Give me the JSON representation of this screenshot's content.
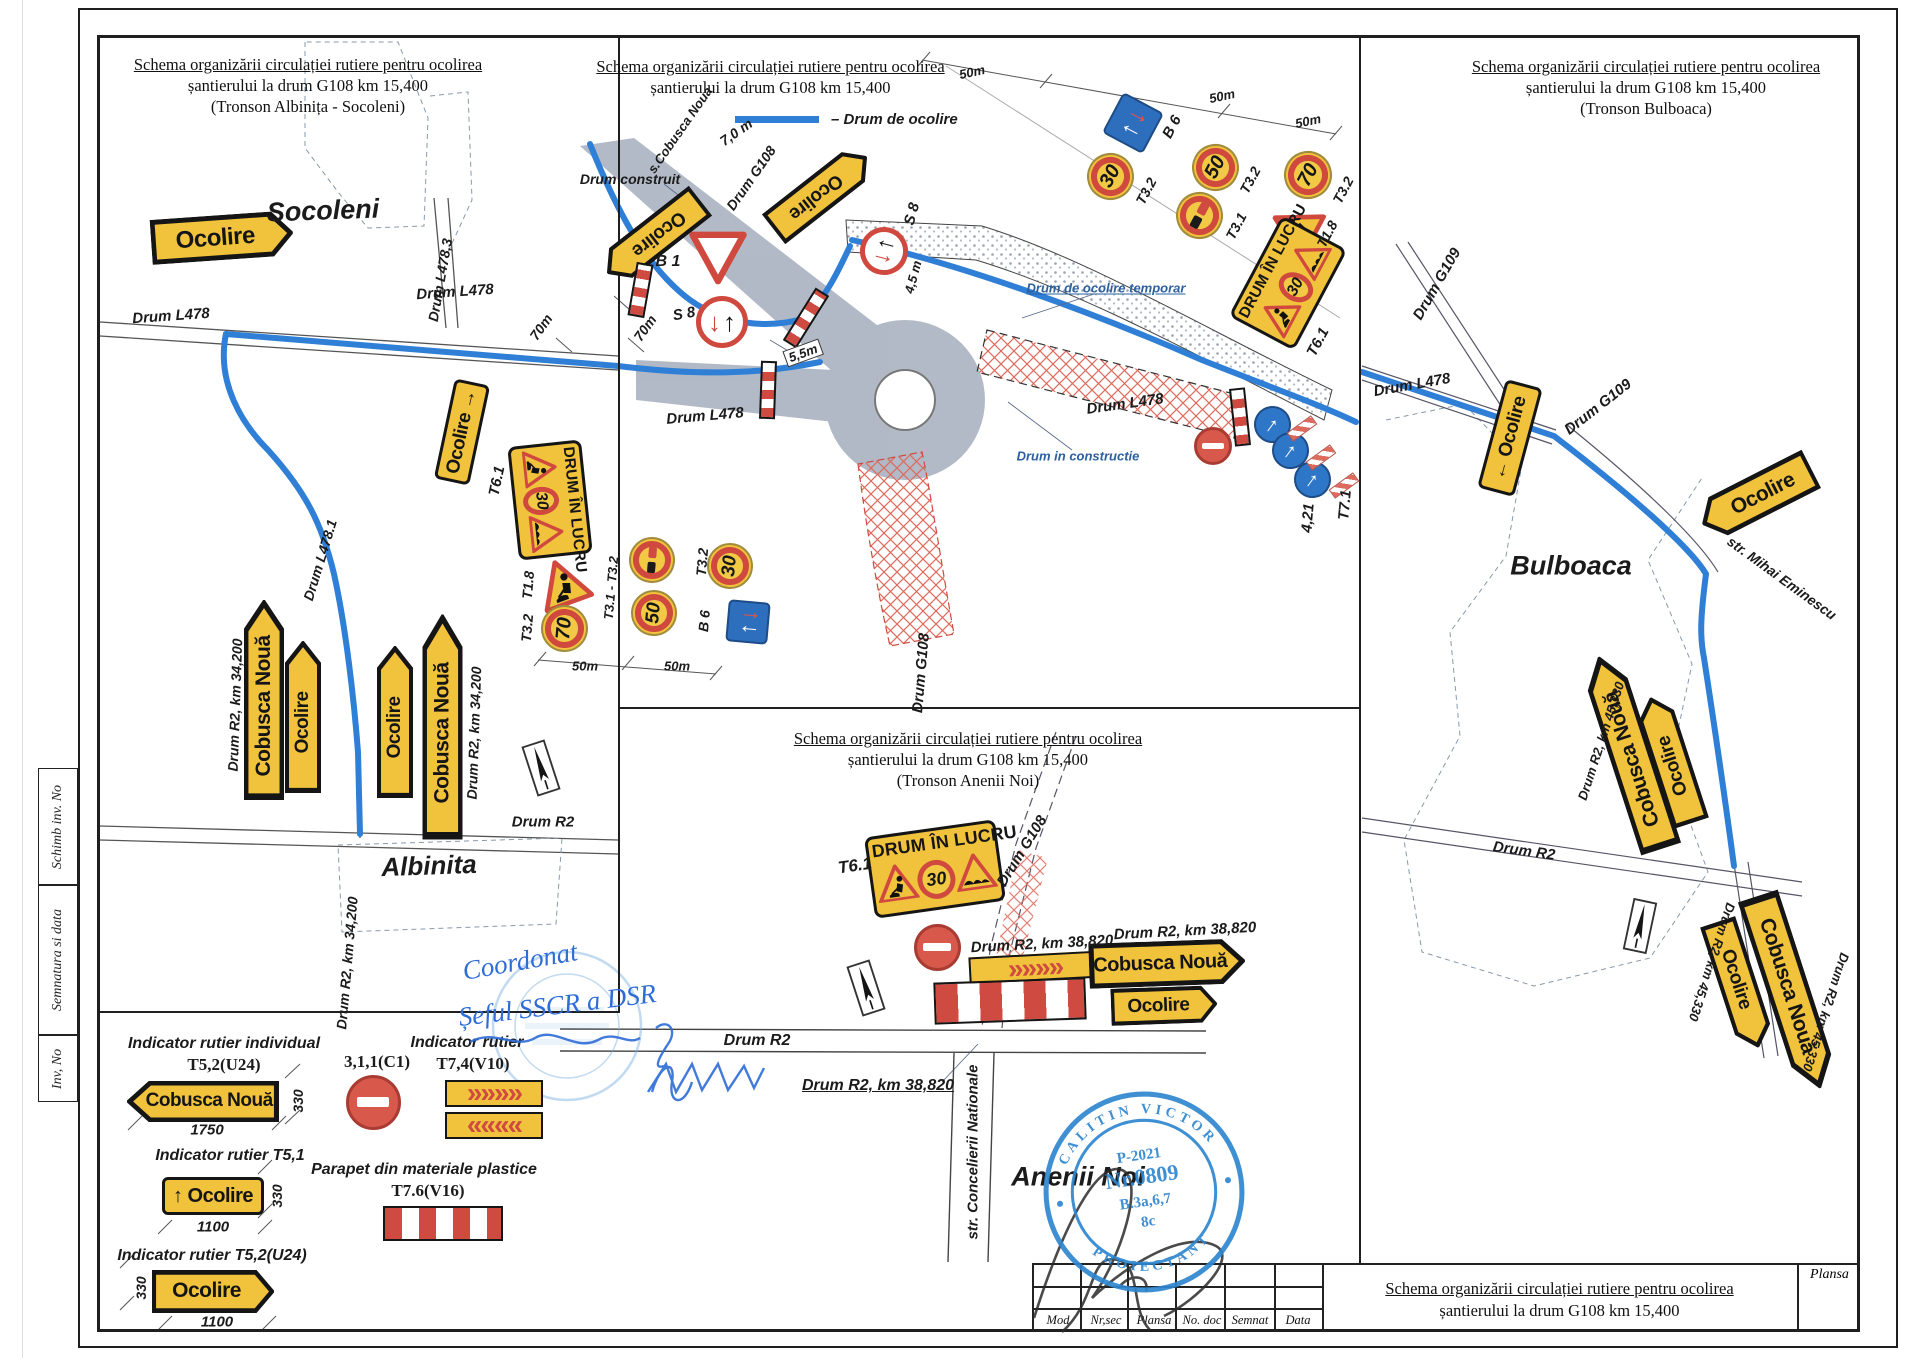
{
  "panels": {
    "left": {
      "l1": "Schema organizării circulației rutiere pentru ocolirea",
      "l2": "șantierului la drum G108 km 15,400",
      "l3": "(Tronson Albinița - Socoleni)"
    },
    "center": {
      "l1": "Schema organizării circulației rutiere pentru ocolirea",
      "l2": "șantierului la drum G108 km 15,400",
      "legend": "– Drum de ocolire"
    },
    "right": {
      "l1": "Schema organizării circulației rutiere pentru ocolirea",
      "l2": "șantierului la drum G108 km 15,400",
      "l3": "(Tronson Bulboaca)"
    },
    "anenii": {
      "l1": "Schema organizării circulației rutiere pentru ocolirea",
      "l2": "șantierului la drum G108 km 15,400",
      "l3": "(Tronson Anenii Noi)"
    }
  },
  "edge": {
    "top": "Schimb inv. No",
    "mid": "Semnatura si data",
    "bot": "Inv, No"
  },
  "titleblock": {
    "headers": [
      "Mod",
      "Nr,sec",
      "Plansa",
      "No. doc",
      "Semnat",
      "Data"
    ],
    "title_l1": "Schema organizării circulației rutiere pentru ocolirea",
    "title_l2": "șantierului la drum G108 km 15,400",
    "plansa": "Plansa"
  },
  "stamp": {
    "arc_top": "CALITIN  VICTOR",
    "arc_bottom": "PROIECTANT",
    "c1": "P-2021",
    "c2": "Nr.0809",
    "c3": "B.3a,6,7",
    "c4": "8c"
  },
  "handwriting": {
    "l1": "Coordonat",
    "l2": "Șeful SSCR a DSR"
  },
  "icons": {
    "arrow_up": "↑",
    "arrow_down": "↓",
    "chev_right": "»»»»",
    "chev_left": "««««"
  },
  "labels": [
    {
      "t": "Socoleni",
      "x": 323,
      "y": 211,
      "r": -2,
      "fs": 27
    },
    {
      "t": "Drum L478",
      "x": 171,
      "y": 316,
      "r": -4,
      "fs": 15
    },
    {
      "t": "Drum L478,3",
      "x": 440,
      "y": 280,
      "r": -80,
      "fs": 14
    },
    {
      "t": "Drum L478",
      "x": 455,
      "y": 292,
      "r": -4,
      "fs": 15
    },
    {
      "t": "Drum L478.1",
      "x": 320,
      "y": 560,
      "r": -73,
      "fs": 14
    },
    {
      "t": "T6.1",
      "x": 497,
      "y": 481,
      "r": -78,
      "fs": 15
    },
    {
      "t": "T1.8",
      "x": 528,
      "y": 585,
      "r": -85,
      "fs": 14
    },
    {
      "t": "T3.2",
      "x": 527,
      "y": 628,
      "r": -85,
      "fs": 14
    },
    {
      "t": "50m",
      "x": 585,
      "y": 666,
      "fs": 13
    },
    {
      "t": "T3.1 - T3.2",
      "x": 611,
      "y": 588,
      "r": -85,
      "fs": 13
    },
    {
      "t": "50m",
      "x": 677,
      "y": 666,
      "fs": 13
    },
    {
      "t": "T3.2",
      "x": 702,
      "y": 562,
      "r": -85,
      "fs": 14
    },
    {
      "t": "B 6",
      "x": 704,
      "y": 621,
      "r": -85,
      "fs": 14
    },
    {
      "t": "Drum R2, km 34,200",
      "x": 235,
      "y": 705,
      "r": -88,
      "fs": 14
    },
    {
      "t": "Drum R2, km 34,200",
      "x": 474,
      "y": 733,
      "r": -88,
      "fs": 14
    },
    {
      "t": "Drum R2",
      "x": 543,
      "y": 822,
      "fs": 15
    },
    {
      "t": "Drum R2, km 34,200",
      "x": 347,
      "y": 963,
      "r": -85,
      "fs": 14
    },
    {
      "t": "Albinita",
      "x": 429,
      "y": 866,
      "r": -2,
      "fs": 26
    },
    {
      "t": "s.Cobusca Noua",
      "x": 680,
      "y": 130,
      "r": -55,
      "fs": 13
    },
    {
      "t": "7,0 m",
      "x": 736,
      "y": 132,
      "r": -35,
      "fs": 14
    },
    {
      "t": "Drum G108",
      "x": 751,
      "y": 178,
      "r": -55,
      "fs": 14
    },
    {
      "t": "Drum construit",
      "x": 630,
      "y": 179,
      "fs": 14
    },
    {
      "t": "B 1",
      "x": 668,
      "y": 262,
      "fs": 16
    },
    {
      "t": "S 8",
      "x": 684,
      "y": 314,
      "r": -10,
      "fs": 15
    },
    {
      "t": "S 8",
      "x": 912,
      "y": 214,
      "r": -75,
      "fs": 15
    },
    {
      "t": "70m",
      "x": 645,
      "y": 328,
      "r": -55,
      "fs": 14
    },
    {
      "t": "70m",
      "x": 541,
      "y": 327,
      "r": -55,
      "fs": 14
    },
    {
      "t": "4,5 m",
      "x": 913,
      "y": 277,
      "r": -75,
      "fs": 13
    },
    {
      "t": "5,5m",
      "x": 803,
      "y": 353,
      "r": -20,
      "fs": 13,
      "bx": true
    },
    {
      "t": "Drum L478",
      "x": 705,
      "y": 416,
      "r": -5,
      "fs": 15
    },
    {
      "t": "Drum L478",
      "x": 1125,
      "y": 404,
      "r": -8,
      "fs": 15
    },
    {
      "t": "Drum de ocolire temporar",
      "x": 1106,
      "y": 288,
      "fs": 13,
      "b": true,
      "u": true
    },
    {
      "t": "Drum in constructie",
      "x": 1078,
      "y": 456,
      "fs": 13,
      "b": true
    },
    {
      "t": "Drum G108",
      "x": 921,
      "y": 673,
      "r": -85,
      "fs": 15
    },
    {
      "t": "50m",
      "x": 972,
      "y": 72,
      "r": -12,
      "fs": 13
    },
    {
      "t": "50m",
      "x": 1222,
      "y": 96,
      "r": -12,
      "fs": 13
    },
    {
      "t": "50m",
      "x": 1308,
      "y": 121,
      "r": -12,
      "fs": 13
    },
    {
      "t": "B 6",
      "x": 1172,
      "y": 127,
      "r": -62,
      "fs": 15
    },
    {
      "t": "T3.2",
      "x": 1146,
      "y": 191,
      "r": -62,
      "fs": 14
    },
    {
      "t": "T3.2",
      "x": 1250,
      "y": 180,
      "r": -62,
      "fs": 14
    },
    {
      "t": "T3.1",
      "x": 1236,
      "y": 226,
      "r": -62,
      "fs": 14
    },
    {
      "t": "T3.2",
      "x": 1343,
      "y": 190,
      "r": -62,
      "fs": 14
    },
    {
      "t": "T1.8",
      "x": 1327,
      "y": 234,
      "r": -62,
      "fs": 14
    },
    {
      "t": "T6.1",
      "x": 1318,
      "y": 342,
      "r": -62,
      "fs": 15
    },
    {
      "t": "4,21",
      "x": 1308,
      "y": 518,
      "r": -85,
      "fs": 15
    },
    {
      "t": "T7.1",
      "x": 1345,
      "y": 505,
      "r": -85,
      "fs": 15
    },
    {
      "t": "Drum G109",
      "x": 1437,
      "y": 284,
      "r": -60,
      "fs": 15
    },
    {
      "t": "Drum L478",
      "x": 1412,
      "y": 385,
      "r": -10,
      "fs": 15
    },
    {
      "t": "Drum G109",
      "x": 1598,
      "y": 407,
      "r": -38,
      "fs": 15
    },
    {
      "t": "Bulboaca",
      "x": 1571,
      "y": 566,
      "fs": 27
    },
    {
      "t": "str. Mihai Eminescu",
      "x": 1782,
      "y": 578,
      "r": 36,
      "fs": 14
    },
    {
      "t": "Drum R2, km 45,330",
      "x": 1601,
      "y": 741,
      "r": -72,
      "fs": 13
    },
    {
      "t": "Drum R2",
      "x": 1524,
      "y": 851,
      "r": 8,
      "fs": 15
    },
    {
      "t": "Drum R2, km 45,330",
      "x": 1712,
      "y": 962,
      "r": 108,
      "fs": 13
    },
    {
      "t": "Drum R2, km 45,330",
      "x": 1826,
      "y": 1012,
      "r": 108,
      "fs": 13
    },
    {
      "t": "T6.1",
      "x": 855,
      "y": 866,
      "r": -8,
      "fs": 17
    },
    {
      "t": "Drum G108",
      "x": 1022,
      "y": 851,
      "r": -58,
      "fs": 15
    },
    {
      "t": "Drum R2, km 38,820",
      "x": 1042,
      "y": 944,
      "r": -3,
      "fs": 15
    },
    {
      "t": "Drum R2, km 38,820",
      "x": 1185,
      "y": 931,
      "r": -3,
      "fs": 15
    },
    {
      "t": "Drum R2",
      "x": 757,
      "y": 1041,
      "fs": 16
    },
    {
      "t": "Drum R2, km 38,820",
      "x": 878,
      "y": 1086,
      "fs": 16,
      "u": true
    },
    {
      "t": "str. Concelierii Nationale",
      "x": 973,
      "y": 1152,
      "r": -90,
      "fs": 15
    },
    {
      "t": "Anenii Noi",
      "x": 1078,
      "y": 1177,
      "fs": 27
    },
    {
      "t": "Indicator rutier individual",
      "x": 224,
      "y": 1044,
      "fs": 16
    },
    {
      "t": "T5,2(U24)",
      "x": 224,
      "y": 1065,
      "fs": 17,
      "sf": true
    },
    {
      "t": "330",
      "x": 298,
      "y": 1101,
      "r": -90,
      "fs": 14
    },
    {
      "t": "1750",
      "x": 207,
      "y": 1130,
      "fs": 15
    },
    {
      "t": "3,1,1(C1)",
      "x": 377,
      "y": 1062,
      "fs": 17,
      "sf": true
    },
    {
      "t": "Indicator rutier",
      "x": 467,
      "y": 1043,
      "fs": 16
    },
    {
      "t": "T7,4(V10)",
      "x": 473,
      "y": 1064,
      "fs": 17,
      "sf": true
    },
    {
      "t": "Indicator rutier T5,1",
      "x": 230,
      "y": 1156,
      "fs": 16
    },
    {
      "t": "330",
      "x": 277,
      "y": 1196,
      "r": -90,
      "fs": 14
    },
    {
      "t": "1100",
      "x": 213,
      "y": 1227,
      "fs": 15
    },
    {
      "t": "Parapet din materiale plastice",
      "x": 424,
      "y": 1170,
      "fs": 16
    },
    {
      "t": "T7.6(V16)",
      "x": 428,
      "y": 1191,
      "fs": 17,
      "sf": true
    },
    {
      "t": "Indicator rutier T5,2(U24)",
      "x": 212,
      "y": 1256,
      "fs": 16
    },
    {
      "t": "330",
      "x": 141,
      "y": 1288,
      "r": -90,
      "fs": 14
    },
    {
      "t": "1100",
      "x": 217,
      "y": 1322,
      "fs": 15
    }
  ],
  "signs": [
    {
      "k": "aR",
      "t": "Ocolire",
      "x": 222,
      "y": 237,
      "w": 142,
      "h": 45,
      "r": -4,
      "fs": 24
    },
    {
      "k": "rect",
      "t": "Ocolire →",
      "x": 462,
      "y": 432,
      "w": 102,
      "h": 36,
      "r": -78,
      "fs": 19
    },
    {
      "k": "lucru",
      "t": "DRUM ÎN LUCRU",
      "v": "30",
      "x": 550,
      "y": 500,
      "w": 114,
      "h": 74,
      "r": 84
    },
    {
      "k": "warnW",
      "x": 563,
      "y": 585,
      "d": 52,
      "r": -20
    },
    {
      "k": "circ",
      "t": "70",
      "x": 564,
      "y": 628,
      "d": 47,
      "r": -85
    },
    {
      "k": "noov",
      "x": 652,
      "y": 560,
      "d": 46,
      "r": -85
    },
    {
      "k": "circ",
      "t": "50",
      "x": 654,
      "y": 613,
      "d": 46,
      "r": -85
    },
    {
      "k": "circ",
      "t": "30",
      "x": 730,
      "y": 566,
      "d": 46,
      "r": -85
    },
    {
      "k": "b6",
      "x": 748,
      "y": 622,
      "w": 42,
      "h": 42,
      "r": -85
    },
    {
      "k": "aR",
      "t": "Cobusca Nouă",
      "x": 264,
      "y": 700,
      "w": 200,
      "h": 40,
      "r": -90,
      "fs": 21
    },
    {
      "k": "aR",
      "t": "Ocolire",
      "x": 303,
      "y": 717,
      "w": 152,
      "h": 36,
      "r": -90,
      "fs": 19
    },
    {
      "k": "aR",
      "t": "Ocolire",
      "x": 395,
      "y": 722,
      "w": 152,
      "h": 36,
      "r": -90,
      "fs": 19
    },
    {
      "k": "aR",
      "t": "Cobusca Nouă",
      "x": 442,
      "y": 727,
      "w": 225,
      "h": 40,
      "r": -90,
      "fs": 21
    },
    {
      "k": "comp",
      "x": 541,
      "y": 768,
      "r": -18
    },
    {
      "k": "aR",
      "t": "Ocolire",
      "x": 654,
      "y": 237,
      "w": 118,
      "h": 38,
      "r": 142,
      "fs": 19
    },
    {
      "k": "aL",
      "t": "Ocolire",
      "x": 820,
      "y": 193,
      "w": 118,
      "h": 38,
      "r": 142,
      "fs": 19
    },
    {
      "k": "yield",
      "x": 718,
      "y": 258,
      "d": 58
    },
    {
      "k": "b5",
      "x": 722,
      "y": 322,
      "d": 52
    },
    {
      "k": "b5",
      "x": 884,
      "y": 251,
      "d": 48,
      "r": -75
    },
    {
      "k": "bar",
      "x": 640,
      "y": 290,
      "w": 17,
      "h": 54,
      "r": 10
    },
    {
      "k": "bar",
      "x": 806,
      "y": 318,
      "w": 62,
      "h": 16,
      "r": -58
    },
    {
      "k": "bar",
      "x": 768,
      "y": 390,
      "w": 16,
      "h": 58,
      "r": 2
    },
    {
      "k": "noent",
      "x": 1213,
      "y": 446,
      "d": 38
    },
    {
      "k": "bar",
      "x": 1240,
      "y": 417,
      "w": 16,
      "h": 58,
      "r": -6
    },
    {
      "k": "bluea",
      "x": 1272,
      "y": 424,
      "d": 37,
      "r": 36
    },
    {
      "k": "bluea",
      "x": 1290,
      "y": 450,
      "d": 37,
      "r": 36
    },
    {
      "k": "bluea",
      "x": 1312,
      "y": 479,
      "d": 37,
      "r": 36
    },
    {
      "k": "hbar",
      "x": 1302,
      "y": 428,
      "w": 30,
      "h": 11,
      "r": -36
    },
    {
      "k": "hbar",
      "x": 1321,
      "y": 457,
      "w": 30,
      "h": 11,
      "r": -36
    },
    {
      "k": "hbar",
      "x": 1344,
      "y": 485,
      "w": 30,
      "h": 11,
      "r": -36
    },
    {
      "k": "b6",
      "x": 1133,
      "y": 123,
      "w": 46,
      "h": 46,
      "r": -62
    },
    {
      "k": "circ",
      "t": "30",
      "x": 1110,
      "y": 176,
      "d": 47,
      "r": -62
    },
    {
      "k": "circ",
      "t": "50",
      "x": 1215,
      "y": 167,
      "d": 47,
      "r": -62
    },
    {
      "k": "noov",
      "x": 1199,
      "y": 215,
      "d": 47,
      "r": -62
    },
    {
      "k": "circ",
      "t": "70",
      "x": 1308,
      "y": 175,
      "d": 48,
      "r": -62
    },
    {
      "k": "warnW",
      "x": 1296,
      "y": 229,
      "d": 52,
      "r": -62
    },
    {
      "k": "lucru",
      "t": "DRUM ÎN LUCRU",
      "v": "30",
      "x": 1288,
      "y": 283,
      "w": 114,
      "h": 74,
      "r": -62
    },
    {
      "k": "lucru",
      "t": "DRUM ÎN LUCRU",
      "v": "30",
      "x": 935,
      "y": 869,
      "w": 132,
      "h": 82,
      "r": -8
    },
    {
      "k": "noent",
      "x": 937,
      "y": 947,
      "d": 47
    },
    {
      "k": "chevR",
      "x": 1035,
      "y": 967,
      "w": 132,
      "h": 27,
      "r": -3
    },
    {
      "k": "bar",
      "x": 1010,
      "y": 1001,
      "w": 152,
      "h": 42,
      "r": -2
    },
    {
      "k": "comp",
      "x": 866,
      "y": 988,
      "r": -18
    },
    {
      "k": "aR",
      "t": "Cobusca Nouă",
      "x": 1167,
      "y": 963,
      "w": 156,
      "h": 45,
      "r": -2,
      "fs": 20
    },
    {
      "k": "aR",
      "t": "Ocolire",
      "x": 1164,
      "y": 1005,
      "w": 106,
      "h": 37,
      "r": -2,
      "fs": 19
    },
    {
      "k": "rect",
      "t": "← Ocolire",
      "x": 1510,
      "y": 438,
      "w": 112,
      "h": 38,
      "r": -75,
      "fs": 19
    },
    {
      "k": "aL",
      "t": "Ocolire",
      "x": 1757,
      "y": 496,
      "w": 122,
      "h": 43,
      "r": -27,
      "fs": 21
    },
    {
      "k": "aR",
      "t": "Cobusca Nouă",
      "x": 1630,
      "y": 753,
      "w": 202,
      "h": 42,
      "r": -108,
      "fs": 21
    },
    {
      "k": "aR",
      "t": "Ocolire",
      "x": 1671,
      "y": 760,
      "w": 132,
      "h": 37,
      "r": -108,
      "fs": 19
    },
    {
      "k": "aR",
      "t": "Ocolire",
      "x": 1738,
      "y": 984,
      "w": 132,
      "h": 37,
      "r": 72,
      "fs": 19
    },
    {
      "k": "aR",
      "t": "Cobusca Nouă",
      "x": 1789,
      "y": 992,
      "w": 202,
      "h": 42,
      "r": 72,
      "fs": 21
    },
    {
      "k": "comp",
      "x": 1640,
      "y": 926,
      "r": 12
    },
    {
      "k": "aL",
      "t": "Cobusca Nouă",
      "x": 203,
      "y": 1101,
      "w": 152,
      "h": 41,
      "fs": 19
    },
    {
      "k": "noent",
      "x": 373,
      "y": 1102,
      "d": 55
    },
    {
      "k": "chevR",
      "x": 494,
      "y": 1093,
      "w": 98,
      "h": 27
    },
    {
      "k": "chevL",
      "x": 494,
      "y": 1125,
      "w": 98,
      "h": 27
    },
    {
      "k": "rect",
      "t": "↑ Ocolire",
      "x": 213,
      "y": 1196,
      "w": 102,
      "h": 38,
      "fs": 20
    },
    {
      "k": "bar",
      "x": 443,
      "y": 1223,
      "w": 120,
      "h": 35
    },
    {
      "k": "aR",
      "t": "Ocolire",
      "x": 213,
      "y": 1291,
      "w": 122,
      "h": 43,
      "fs": 21
    }
  ]
}
